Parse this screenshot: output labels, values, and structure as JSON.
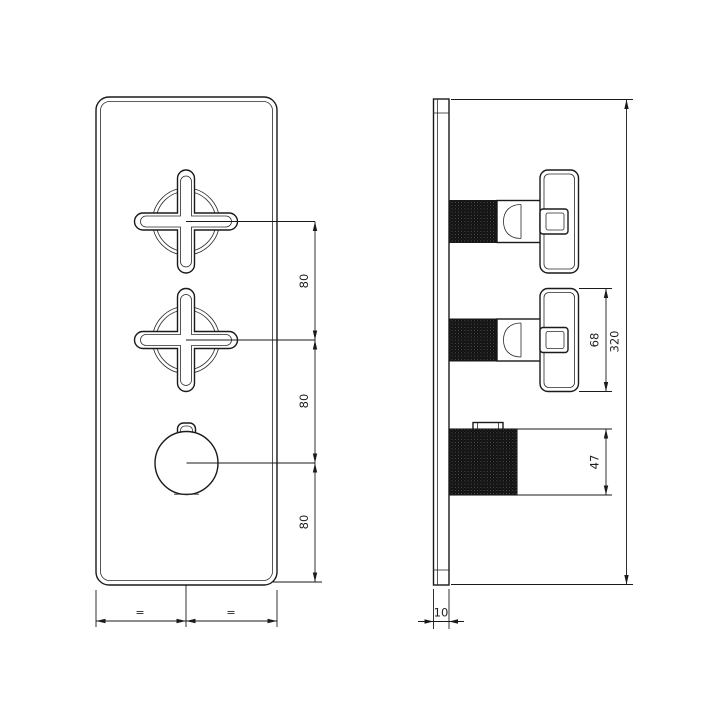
{
  "colors": {
    "line": "#1a1a1a",
    "background": "#ffffff",
    "knurl_fill": "#101010"
  },
  "front_view": {
    "spacing_top": "80",
    "spacing_middle": "80",
    "spacing_bottom": "80",
    "equal_left": "=",
    "equal_right": "="
  },
  "side_view": {
    "handle_height": "68",
    "knob_height": "47",
    "total_height": "320",
    "plate_thickness": "10"
  }
}
